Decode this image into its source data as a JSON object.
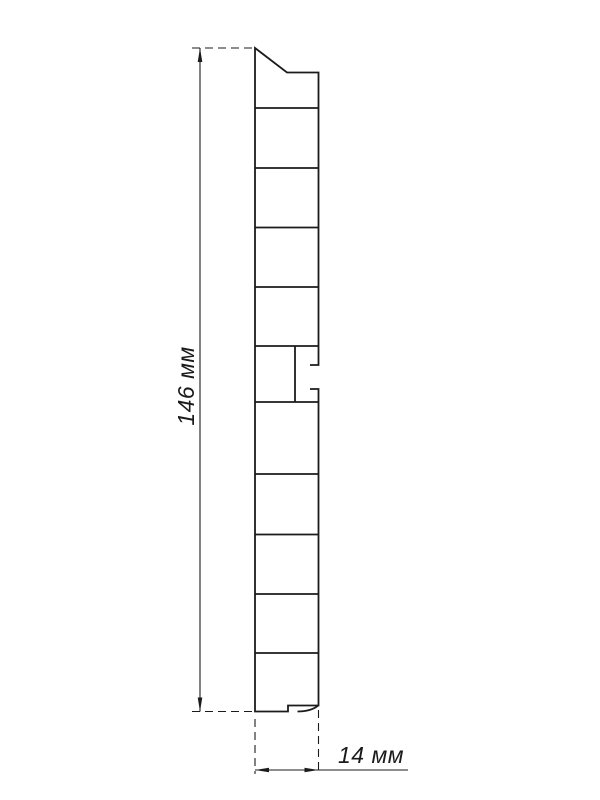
{
  "page": {
    "background_color": "#ffffff",
    "line_color": "#1b1b1b"
  },
  "diagram": {
    "height_dimension": {
      "value": "146",
      "unit": "мм",
      "label": "146 мм"
    },
    "width_dimension": {
      "value": "14",
      "unit": "мм",
      "label": "14 мм"
    }
  }
}
